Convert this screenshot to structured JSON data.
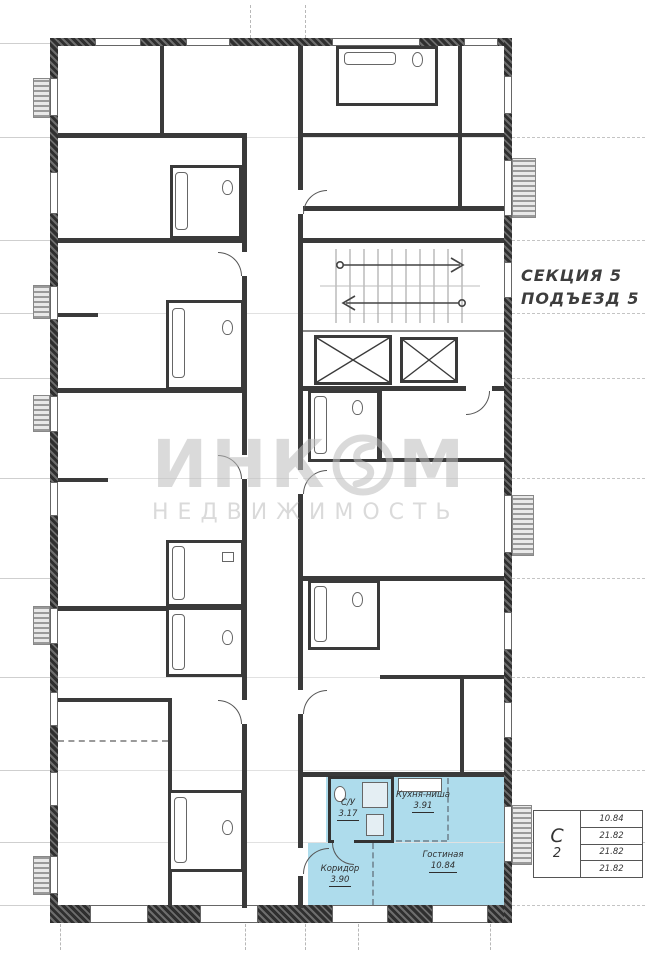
{
  "plan": {
    "section_label": "СЕКЦИЯ 5",
    "entrance_label": "ПОДЪЕЗД 5"
  },
  "watermark": {
    "brand_left": "ИНК",
    "brand_right": "М",
    "subtitle": "НЕДВИЖИМОСТЬ"
  },
  "apartment": {
    "highlight_color": "#aedcec",
    "rooms": [
      {
        "name": "С/У",
        "area": "3.17"
      },
      {
        "name": "Кухня-ниша",
        "area": "3.91"
      },
      {
        "name": "Гостиная",
        "area": "10.84"
      },
      {
        "name": "Коридор",
        "area": "3.90"
      }
    ]
  },
  "stamp": {
    "type_letter": "С",
    "rooms_count": "2",
    "areas": [
      "10.84",
      "21.82",
      "21.82",
      "21.82"
    ]
  }
}
